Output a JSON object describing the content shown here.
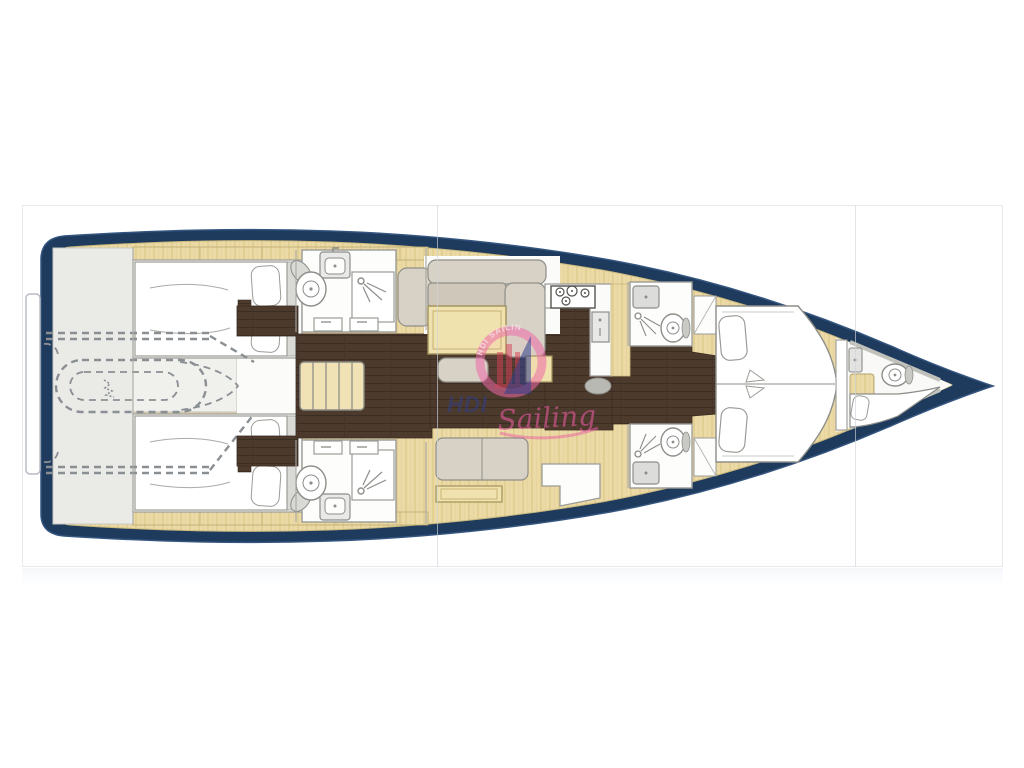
{
  "page": {
    "background": "#ffffff",
    "panel_border": "#e7e9ec",
    "gallery_panel_count": 3,
    "divider_positions_px": [
      437,
      855
    ]
  },
  "watermark": {
    "word_blue": "HDI",
    "word_pink": "Sailing",
    "arc_text": "HDI SAILING",
    "ring_pink": "#ef6aa8",
    "sail_blue": "#2e3f8e",
    "bars_red": "#d84055"
  },
  "colors": {
    "hull_navy": "#1e3a5c",
    "hull_highlight": "#34557f",
    "interior_white": "#fbfbf9",
    "deck_wood": "#ecdaa6",
    "deck_wood_stripe": "#e2cf94",
    "floor_walnut": "#4c3a2d",
    "stern_gray": "#eaeae7",
    "furniture_gray": "#d8d2c6",
    "fixture_outline": "#8d8d89",
    "table_wood": "#f0e2ae",
    "dashed_outline_gray": "#8a8f94"
  },
  "plan": {
    "type": "yacht-interior-deck-plan",
    "orientation": "bow-right",
    "areas": [
      "swim-platform",
      "tender-garage",
      "aft-cabin-port",
      "aft-cabin-starboard",
      "aft-head-port",
      "aft-head-starboard",
      "companionway-stairs",
      "salon",
      "galley",
      "forward-head-port",
      "forward-head-starboard",
      "forward-cabin",
      "forepeak-cabin"
    ],
    "fixture_counts": {
      "beds": 4,
      "toilets": 5,
      "sinks": 6,
      "showers": 4,
      "stove_burners": 4,
      "stair_treads": 5
    }
  }
}
